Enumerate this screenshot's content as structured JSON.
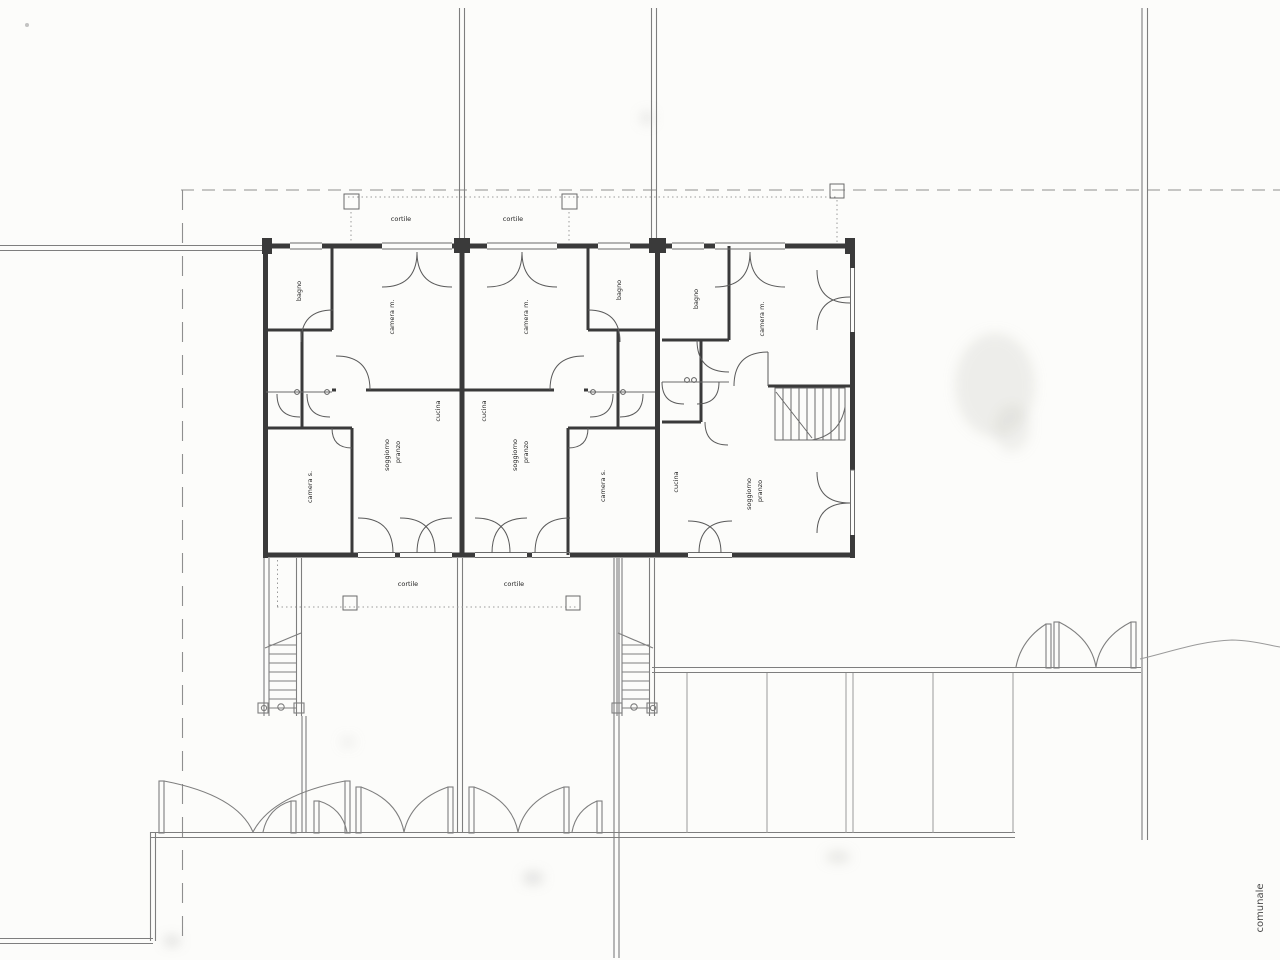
{
  "page": {
    "background_color": "#fcfcfa",
    "ink_color": "#3a3a3a",
    "site_line_color": "#7e7e7e"
  },
  "plan": {
    "room_labels": [
      {
        "text": "bagno"
      },
      {
        "text": "camera m."
      },
      {
        "text": "cucina"
      },
      {
        "text": "soggiorno"
      },
      {
        "text": "pranzo"
      },
      {
        "text": "camera s."
      },
      {
        "text": "camera m."
      },
      {
        "text": "bagno"
      },
      {
        "text": "cucina"
      },
      {
        "text": "soggiorno"
      },
      {
        "text": "pranzo"
      },
      {
        "text": "camera s."
      },
      {
        "text": "bagno"
      },
      {
        "text": "camera m."
      },
      {
        "text": "cucina"
      },
      {
        "text": "soggiorno"
      },
      {
        "text": "pranzo"
      }
    ],
    "site_labels": [
      {
        "text": "cortile"
      },
      {
        "text": "cortile"
      },
      {
        "text": "cortile"
      },
      {
        "text": "cortile"
      }
    ],
    "street_label": {
      "text": "comunale"
    }
  }
}
